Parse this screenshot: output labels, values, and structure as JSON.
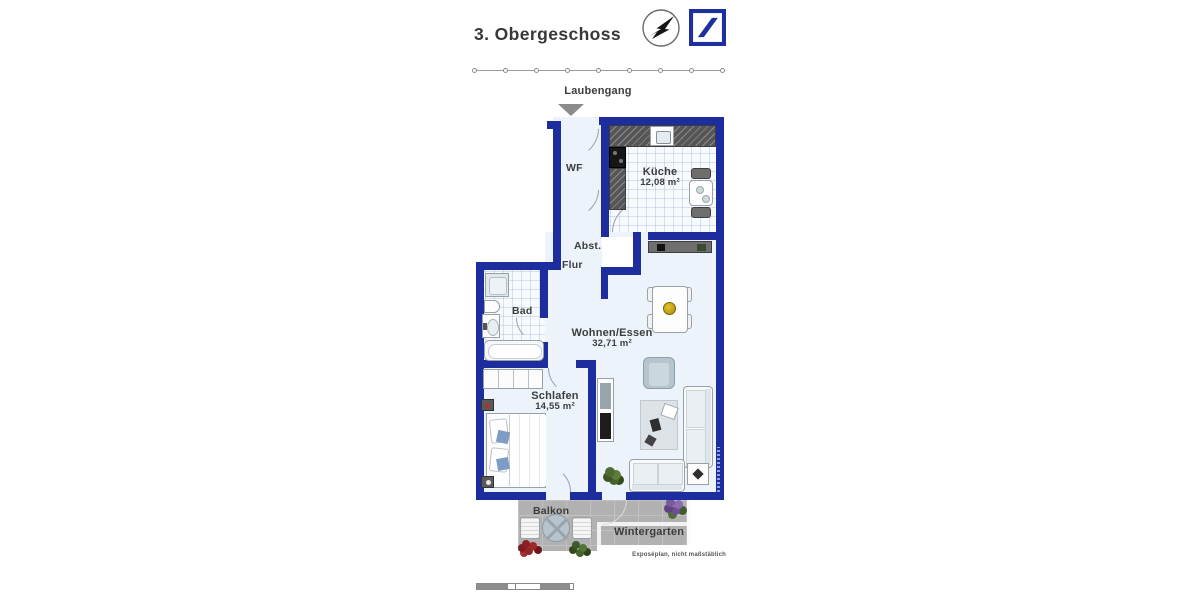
{
  "header": {
    "title": "3. Obergeschoss",
    "compass_icon": "compass-north-icon",
    "brand_logo": "deutsche-bank-logo"
  },
  "plan": {
    "laubengang": "Laubengang",
    "entrance_marker": "entrance-arrow-icon",
    "rooms": {
      "wf": {
        "label": "WF"
      },
      "kueche": {
        "label": "Küche",
        "area": "12,08 m²"
      },
      "abst": {
        "label": "Abst."
      },
      "flur": {
        "label": "Flur"
      },
      "bad": {
        "label": "Bad"
      },
      "wohnen": {
        "label": "Wohnen/Essen",
        "area": "32,71 m²"
      },
      "schlafen": {
        "label": "Schlafen",
        "area": "14,55 m²"
      },
      "balkon": {
        "label": "Balkon"
      },
      "wintergarten": {
        "label": "Wintergarten"
      }
    },
    "colors": {
      "wall": "#1e2d9e",
      "logo": "#1e2fa0",
      "floor": "#edf3fa",
      "balcony": "#b1b1b1",
      "label": "#3d3d3d"
    }
  },
  "footer": {
    "note": "Exposéplan, nicht maßstäblich"
  }
}
